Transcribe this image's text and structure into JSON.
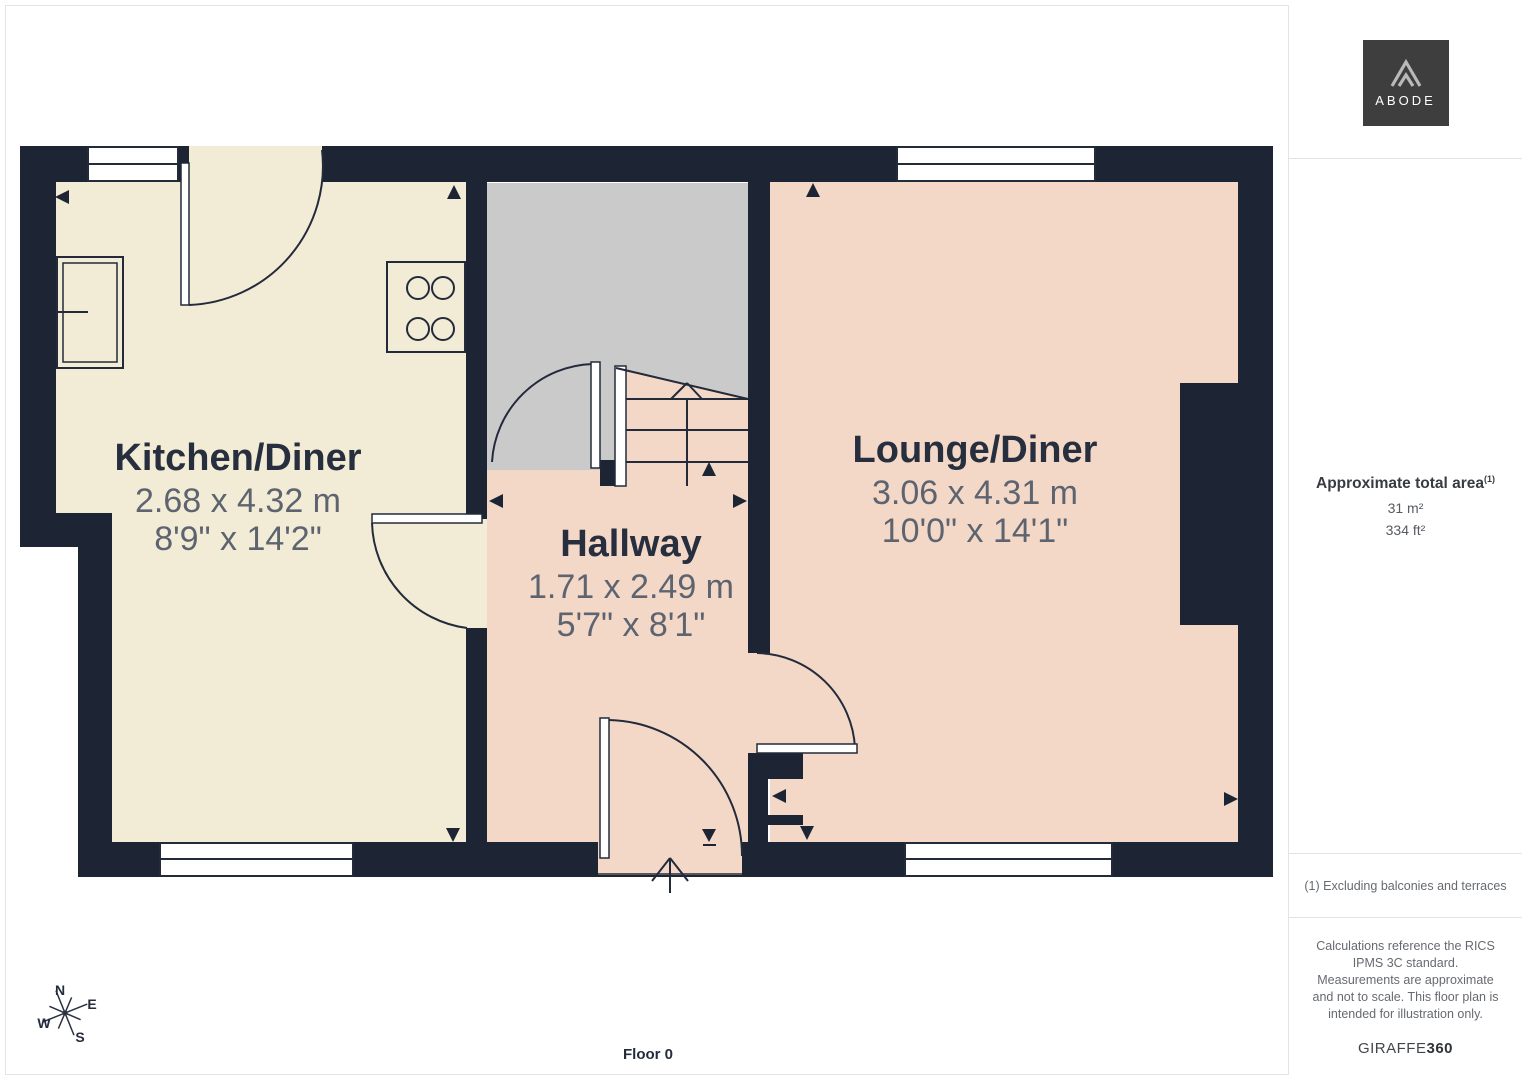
{
  "floor_label": "Floor 0",
  "compass": {
    "n": "N",
    "e": "E",
    "s": "S",
    "w": "W"
  },
  "rooms": [
    {
      "name": "Kitchen/Diner",
      "dim_m": "2.68 x 4.32 m",
      "dim_ft": "8'9\" x 14'2\""
    },
    {
      "name": "Hallway",
      "dim_m": "1.71 x 2.49 m",
      "dim_ft": "5'7\" x 8'1\""
    },
    {
      "name": "Lounge/Diner",
      "dim_m": "3.06 x 4.31 m",
      "dim_ft": "10'0\" x 14'1\""
    }
  ],
  "sidebar": {
    "logo_text": "ABODE",
    "area_title": "Approximate total area",
    "area_superscript": "(1)",
    "area_m2": "31 m²",
    "area_ft2": "334 ft²",
    "footnote": "(1) Excluding balconies and terraces",
    "disclaimer": "Calculations reference the RICS IPMS 3C standard. Measurements are approximate and not to scale. This floor plan is intended for illustration only.",
    "brand": "GIRAFFE",
    "brand_suffix": "360"
  },
  "colors": {
    "wall": "#1d2534",
    "kitchen_floor": "#f2ecd6",
    "hall_floor": "#f3d8c8",
    "stair_void": "#cacaca",
    "line": "#232b3a",
    "room_name_text": "#272e3e",
    "dimension_text": "#5d6470"
  }
}
